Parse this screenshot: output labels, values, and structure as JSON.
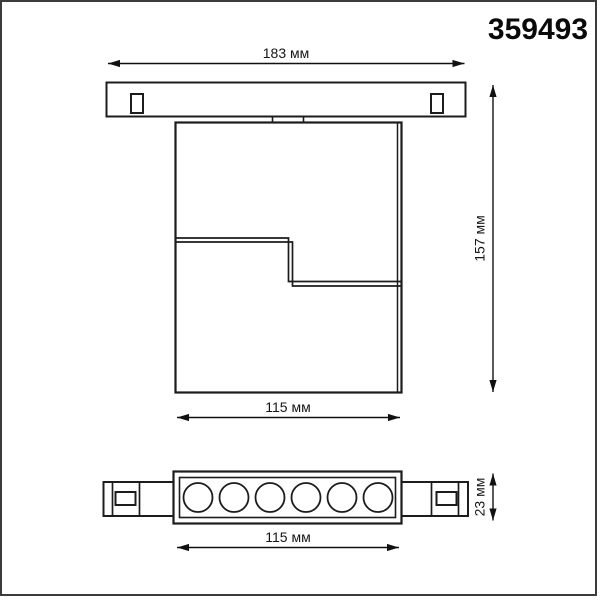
{
  "article_number": "359493",
  "dimensions": {
    "track_width": "183 мм",
    "fixture_height": "157 мм",
    "body_width": "115 мм",
    "module_width": "115 мм",
    "module_height": "23 мм"
  },
  "bottom_view": {
    "lens_count": 6
  },
  "colors": {
    "background": "#ffffff",
    "line_color": "#1c1c1c",
    "page_border_color": "#3b3b3b",
    "text_color": "#111111"
  }
}
